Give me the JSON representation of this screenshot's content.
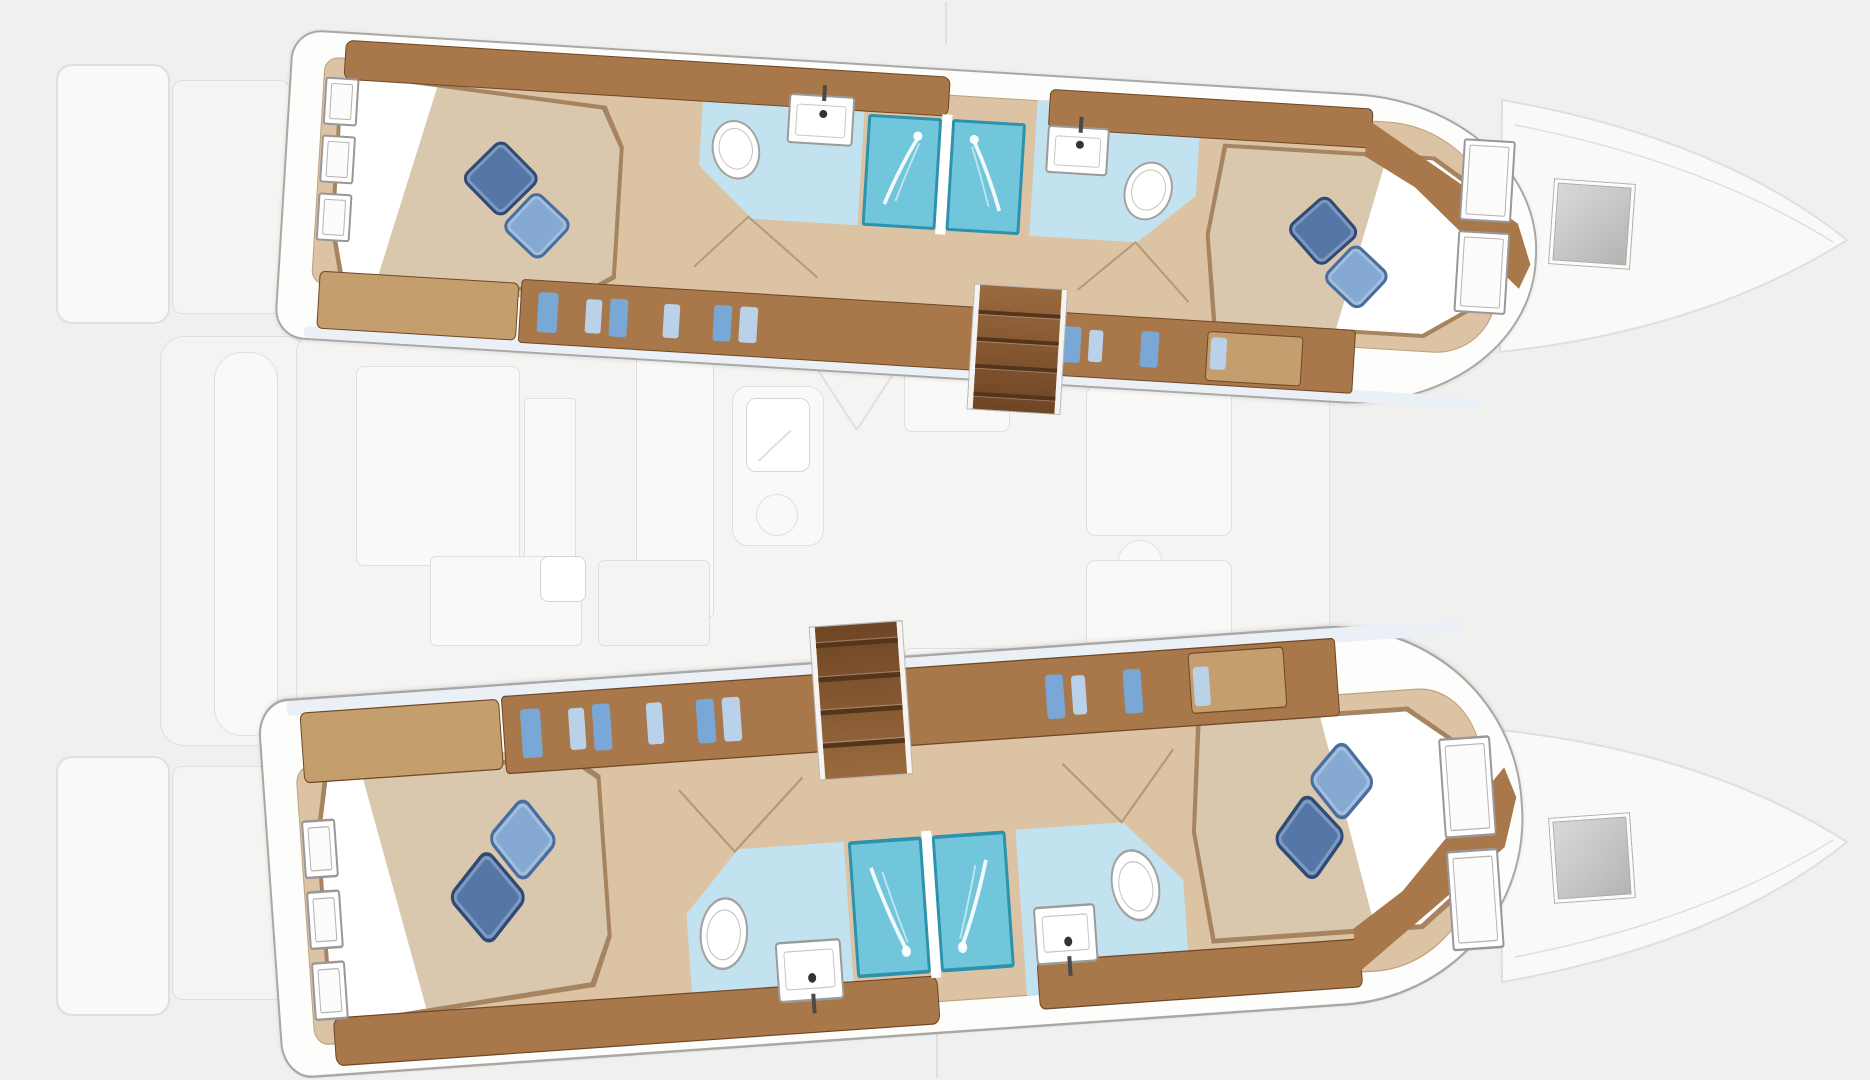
{
  "meta": {
    "description": "Catamaran sailing yacht deck/floor plan, top view. Lower-deck hull accommodations drawn in colour; main deck (saloon, cockpit, foredeck, trampoline, bows) shown as a faint grey ghost outline. No text labels are rendered in the image.",
    "inventory": {
      "double_cabins": 4,
      "bathrooms": 4,
      "shower_stalls": 4,
      "toilets": 4,
      "sinks": 4,
      "companionway_staircases": 2,
      "deck_hatches": 2,
      "pillows_per_bed": 2
    }
  },
  "palette": {
    "bg": "#f0f0ef",
    "ghost_fill": "#f9f9f8",
    "ghost_fill2": "#f4f4f2",
    "ghost_line": "#e0dfdd",
    "hull_fill": "#fdfdfc",
    "hull_line": "#a9a8a5",
    "wood": "#a8784a",
    "wood_dark": "#8a5a33",
    "wood_light": "#c59e6e",
    "wood_edge": "#6f4726",
    "floor": "#dcc3a3",
    "mattress": "#d9c8ad",
    "mattress_edge": "#a5845f",
    "sheet": "#ffffff",
    "pillow_dark": "#5577a8",
    "pillow_dark_edge": "#2e4a75",
    "pillow_light": "#85a9d2",
    "pillow_light_edge": "#4a6da0",
    "aqua": "#c2e2ef",
    "aqua_edge": "#8cc3da",
    "shower": "#72c6dc",
    "shower_edge": "#2d92ad",
    "fixture_edge": "#9b9b98",
    "stair_hi": "#9a6a3e",
    "stair_lo": "#6f4524",
    "stair_tread": "#54351b",
    "stair_rail": "#f5f4f2",
    "hatch_a": "#d9d9d8",
    "hatch_b": "#b3b3b1",
    "window_edge": "#98979a",
    "icon_blue": "#79a7d6",
    "icon_blue2": "#b9d2ea",
    "door_line": "#a98b66"
  },
  "ghost_paths": [
    {
      "n": "bow-deck-port",
      "d": "M1502,100 Q1720,138 1847,240 Q1705,330 1500,352 Z",
      "fill": "ghost_fill",
      "stroke": "ghost_line",
      "sw": 2
    },
    {
      "n": "bow-line-port",
      "d": "M1515,125 Q1705,162 1833,242",
      "fill": "none",
      "stroke": "ghost_line",
      "sw": 1.5
    },
    {
      "n": "bow-deck-starboard",
      "d": "M1500,730 Q1705,752 1847,842 Q1720,944 1502,982 Z",
      "fill": "ghost_fill",
      "stroke": "ghost_line",
      "sw": 2
    },
    {
      "n": "bow-line-starboard",
      "d": "M1515,957 Q1705,920 1833,840",
      "fill": "none",
      "stroke": "ghost_line",
      "sw": 1.5
    }
  ],
  "ghost_shapes": [
    {
      "n": "stern-swim-platform-port",
      "k": "rect",
      "x": 56,
      "y": 64,
      "w": 114,
      "h": 260,
      "rad": "16px",
      "f": "ghost_fill",
      "s": "ghost_line",
      "sw": 2,
      "tex": "tex-slats"
    },
    {
      "n": "stern-step-port",
      "k": "rect",
      "x": 172,
      "y": 80,
      "w": 118,
      "h": 234,
      "rad": "10px",
      "f": "ghost_fill2",
      "s": "ghost_line",
      "sw": 1,
      "tex": "tex-slats"
    },
    {
      "n": "stern-swim-platform-starboard",
      "k": "rect",
      "x": 56,
      "y": 756,
      "w": 114,
      "h": 260,
      "rad": "16px",
      "f": "ghost_fill",
      "s": "ghost_line",
      "sw": 2,
      "tex": "tex-slats"
    },
    {
      "n": "stern-step-starboard",
      "k": "rect",
      "x": 172,
      "y": 766,
      "w": 118,
      "h": 234,
      "rad": "10px",
      "f": "ghost_fill2",
      "s": "ghost_line",
      "sw": 1,
      "tex": "tex-slats"
    },
    {
      "n": "aft-cockpit-floor",
      "k": "rect",
      "x": 160,
      "y": 336,
      "w": 150,
      "h": 410,
      "rad": "24px",
      "f": "ghost_fill2",
      "s": "ghost_line",
      "sw": 1
    },
    {
      "n": "saloon-floor",
      "k": "rect",
      "x": 296,
      "y": 334,
      "w": 1034,
      "h": 414,
      "rad": "18px",
      "f": "ghost_fill2",
      "s": "ghost_line",
      "sw": 1,
      "tex": "tex-streaks"
    },
    {
      "n": "aft-cockpit-bench",
      "k": "rect",
      "x": 214,
      "y": 352,
      "w": 64,
      "h": 384,
      "rad": "28px",
      "f": "ghost_fill",
      "s": "ghost_line",
      "sw": 1
    },
    {
      "n": "cockpit-table",
      "k": "rect",
      "x": 356,
      "y": 366,
      "w": 164,
      "h": 200,
      "rad": "8px",
      "f": "ghost_fill",
      "s": "ghost_line",
      "sw": 1
    },
    {
      "n": "galley-strip",
      "k": "rect",
      "x": 524,
      "y": 398,
      "w": 52,
      "h": 176,
      "rad": "4px",
      "f": "ghost_fill",
      "s": "ghost_line",
      "sw": 1
    },
    {
      "n": "galley-counter",
      "k": "rect",
      "x": 636,
      "y": 346,
      "w": 78,
      "h": 272,
      "rad": "6px",
      "f": "ghost_fill",
      "s": "ghost_line",
      "sw": 1
    },
    {
      "n": "galley-sink-unit",
      "k": "rect",
      "x": 732,
      "y": 386,
      "w": 92,
      "h": 160,
      "rad": "16px",
      "f": "ghost_fill",
      "s": "ghost_line",
      "sw": 1.5
    },
    {
      "n": "galley-sink",
      "k": "rect",
      "x": 746,
      "y": 398,
      "w": 64,
      "h": 74,
      "rad": "10px",
      "f": "#ffffff",
      "s": "#d8d7d5",
      "sw": 1.5
    },
    {
      "n": "galley-faucet",
      "k": "line",
      "x1": 758,
      "y1": 460,
      "x2": 790,
      "y2": 430,
      "ghost": true
    },
    {
      "n": "galley-burner",
      "k": "circle",
      "cx": 777,
      "cy": 515,
      "r": 21,
      "f": "none",
      "s": "ghost_line",
      "sw": 1.5
    },
    {
      "n": "saloon-seat",
      "k": "rect",
      "x": 904,
      "y": 336,
      "w": 106,
      "h": 96,
      "rad": "8px",
      "f": "ghost_fill",
      "s": "ghost_line",
      "sw": 1
    },
    {
      "n": "door-swing-ghost-a",
      "k": "line",
      "x1": 806,
      "y1": 350,
      "x2": 858,
      "y2": 430,
      "ghost": true
    },
    {
      "n": "door-swing-ghost-b",
      "k": "line",
      "x1": 910,
      "y1": 350,
      "x2": 858,
      "y2": 430,
      "ghost": true
    },
    {
      "n": "nav-seat",
      "k": "rect",
      "x": 1100,
      "y": 330,
      "w": 100,
      "h": 52,
      "rad": "6px",
      "f": "ghost_fill2",
      "s": "ghost_line",
      "sw": 1
    },
    {
      "n": "nav-table",
      "k": "rect",
      "x": 1086,
      "y": 386,
      "w": 146,
      "h": 150,
      "rad": "10px",
      "f": "ghost_fill",
      "s": "ghost_line",
      "sw": 1
    },
    {
      "n": "stool",
      "k": "circle",
      "cx": 1140,
      "cy": 562,
      "r": 22,
      "f": "ghost_fill",
      "s": "ghost_line",
      "sw": 1.5
    },
    {
      "n": "galley-counter-low",
      "k": "rect",
      "x": 430,
      "y": 556,
      "w": 152,
      "h": 90,
      "rad": "6px",
      "f": "ghost_fill",
      "s": "ghost_line",
      "sw": 1
    },
    {
      "n": "galley-sink-low",
      "k": "rect",
      "x": 540,
      "y": 556,
      "w": 46,
      "h": 46,
      "rad": "8px",
      "f": "#ffffff",
      "s": "#d5d4d2",
      "sw": 1.5
    },
    {
      "n": "counter-low-2",
      "k": "rect",
      "x": 598,
      "y": 560,
      "w": 112,
      "h": 86,
      "rad": "6px",
      "f": "ghost_fill2",
      "s": "ghost_line",
      "sw": 1
    },
    {
      "n": "saloon-seat-low",
      "k": "rect",
      "x": 904,
      "y": 648,
      "w": 106,
      "h": 94,
      "rad": "8px",
      "f": "ghost_fill",
      "s": "ghost_line",
      "sw": 1
    },
    {
      "n": "dinette-low",
      "k": "rect",
      "x": 1086,
      "y": 560,
      "w": 146,
      "h": 128,
      "rad": "10px",
      "f": "ghost_fill",
      "s": "ghost_line",
      "sw": 1
    },
    {
      "n": "mast-line",
      "k": "line",
      "x1": 947,
      "y1": 2,
      "x2": 947,
      "y2": 44,
      "ghost": true
    },
    {
      "n": "forestay-line",
      "k": "line",
      "x1": 938,
      "y1": 1016,
      "x2": 938,
      "y2": 1078,
      "ghost": true
    }
  ],
  "hatches": [
    {
      "n": "deck-hatch-port",
      "x": 1552,
      "y": 182,
      "w": 80,
      "h": 84,
      "rot": 4
    },
    {
      "n": "deck-hatch-starboard",
      "x": 1552,
      "y": 816,
      "w": 80,
      "h": 84,
      "rot": -4
    }
  ],
  "hulls": [
    {
      "id": "hull-port",
      "n": "port-hull-accommodation",
      "left": 283,
      "top": 30,
      "w": 1270,
      "h": 310,
      "origin": "30px 155px",
      "transform": "rotate(3.5deg)",
      "stair_x": 697
    },
    {
      "id": "hull-starboard",
      "n": "starboard-hull-accommodation",
      "left": 283,
      "top": 700,
      "w": 1270,
      "h": 310,
      "origin": "0 0",
      "transform": "translateY(380px) rotate(-4deg) scaleY(-1.226)",
      "stair_x": 557
    }
  ],
  "hull_template": [
    {
      "n": "hull-outline",
      "k": "rect",
      "x": 0,
      "y": 0,
      "w": 1256,
      "h": 310,
      "rad": "30px 190px 190px 30px / 30px 152px 152px 30px",
      "f": "hull_fill",
      "s": "hull_line",
      "sw": 2,
      "shadow": true
    },
    {
      "n": "inboard-edge-band",
      "k": "rect",
      "x": 30,
      "y": 296,
      "w": 1180,
      "h": 12,
      "rad": "4px",
      "f": "#eaf0f5"
    },
    {
      "n": "cabin-sole-floor",
      "k": "rect",
      "x": 34,
      "y": 26,
      "w": 1184,
      "h": 228,
      "rad": "14px 120px 60px 14px",
      "f": "floor",
      "tex": "tex-plank",
      "inset": "0 0 0 1px rgba(150,120,85,.45)"
    },
    {
      "n": "aft-bathroom-floor",
      "k": "poly",
      "pts": [
        [
          414,
          26
        ],
        [
          576,
          26
        ],
        [
          576,
          162
        ],
        [
          470,
          162
        ],
        [
          414,
          112
        ]
      ],
      "f": "aqua",
      "tex": "tex-tile"
    },
    {
      "n": "fwd-bathroom-floor",
      "k": "poly",
      "pts": [
        [
          748,
          26
        ],
        [
          912,
          26
        ],
        [
          912,
          112
        ],
        [
          856,
          162
        ],
        [
          748,
          162
        ]
      ],
      "f": "aqua",
      "tex": "tex-tile"
    },
    {
      "n": "aft-bed-base",
      "k": "poly",
      "pts": [
        [
          62,
          40
        ],
        [
          318,
          58
        ],
        [
          338,
          98
        ],
        [
          338,
          230
        ],
        [
          310,
          248
        ],
        [
          62,
          248
        ],
        [
          50,
          196
        ],
        [
          50,
          92
        ]
      ],
      "f": "mattress_edge"
    },
    {
      "n": "aft-bed",
      "k": "poly",
      "pts": [
        [
          66,
          44
        ],
        [
          314,
          62
        ],
        [
          334,
          100
        ],
        [
          334,
          227
        ],
        [
          307,
          244
        ],
        [
          66,
          244
        ],
        [
          54,
          194
        ],
        [
          54,
          94
        ]
      ],
      "f": "mattress",
      "tex": "tex-mattress"
    },
    {
      "n": "aft-bed-sheet",
      "k": "poly",
      "pts": [
        [
          66,
          44
        ],
        [
          148,
          50
        ],
        [
          100,
          244
        ],
        [
          66,
          244
        ],
        [
          54,
          194
        ],
        [
          54,
          94
        ]
      ],
      "f": "sheet"
    },
    {
      "n": "fwd-bed-base",
      "k": "poly",
      "pts": [
        [
          936,
          58
        ],
        [
          1148,
          58
        ],
        [
          1208,
          96
        ],
        [
          1224,
          148
        ],
        [
          1206,
          202
        ],
        [
          1148,
          240
        ],
        [
          936,
          240
        ],
        [
          924,
          150
        ]
      ],
      "f": "mattress_edge"
    },
    {
      "n": "fwd-bed",
      "k": "poly",
      "pts": [
        [
          940,
          62
        ],
        [
          1146,
          62
        ],
        [
          1204,
          100
        ],
        [
          1220,
          148
        ],
        [
          1202,
          200
        ],
        [
          1146,
          236
        ],
        [
          940,
          236
        ],
        [
          928,
          150
        ]
      ],
      "f": "mattress",
      "tex": "tex-mattress"
    },
    {
      "n": "fwd-bed-sheet",
      "k": "poly",
      "pts": [
        [
          1100,
          62
        ],
        [
          1146,
          62
        ],
        [
          1204,
          100
        ],
        [
          1220,
          148
        ],
        [
          1202,
          200
        ],
        [
          1146,
          236
        ],
        [
          1060,
          236
        ]
      ],
      "f": "sheet"
    },
    {
      "n": "aft-wood-shelf",
      "k": "rect",
      "x": 54,
      "y": 8,
      "w": 606,
      "h": 40,
      "rad": "8px",
      "f": "wood",
      "s": "wood_edge",
      "sw": 1,
      "tex": "tex-woodgrain"
    },
    {
      "n": "fwd-wood-shelf",
      "k": "rect",
      "x": 760,
      "y": 14,
      "w": 324,
      "h": 40,
      "rad": "6px",
      "f": "wood",
      "s": "wood_edge",
      "sw": 1,
      "tex": "tex-woodgrain"
    },
    {
      "n": "bow-trim",
      "k": "poly",
      "pts": [
        [
          1080,
          26
        ],
        [
          1235,
          120
        ],
        [
          1250,
          160
        ],
        [
          1240,
          185
        ],
        [
          1130,
          90
        ],
        [
          1078,
          62
        ]
      ],
      "f": "wood",
      "shadow": true
    },
    {
      "n": "aft-dresser",
      "k": "rect",
      "x": 42,
      "y": 240,
      "w": 200,
      "h": 58,
      "rad": "6px",
      "f": "wood_light",
      "s": "wood_edge",
      "sw": 1,
      "tex": "tex-woodgrain"
    },
    {
      "n": "wardrobe-row",
      "k": "rect",
      "x": 244,
      "y": 236,
      "w": 836,
      "h": 64,
      "rad": "4px",
      "f": "wood",
      "s": "wood_edge",
      "sw": 1,
      "tex": "tex-doors"
    },
    {
      "n": "fwd-dresser",
      "k": "rect",
      "x": 932,
      "y": 246,
      "w": 96,
      "h": 50,
      "rad": "4px",
      "f": "wood_light",
      "s": "wood_edge",
      "sw": 1,
      "tex": "tex-woodgrain"
    },
    {
      "n": "wardrobe-item",
      "k": "rect",
      "x": 262,
      "y": 248,
      "w": 20,
      "h": 40,
      "rad": "3px",
      "f": "icon_blue"
    },
    {
      "n": "wardrobe-item",
      "k": "rect",
      "x": 310,
      "y": 252,
      "w": 16,
      "h": 34,
      "rad": "3px",
      "f": "icon_blue2"
    },
    {
      "n": "wardrobe-item",
      "k": "rect",
      "x": 334,
      "y": 250,
      "w": 18,
      "h": 38,
      "rad": "3px",
      "f": "icon_blue"
    },
    {
      "n": "wardrobe-item",
      "k": "rect",
      "x": 388,
      "y": 252,
      "w": 16,
      "h": 34,
      "rad": "3px",
      "f": "icon_blue2"
    },
    {
      "n": "wardrobe-item",
      "k": "rect",
      "x": 438,
      "y": 250,
      "w": 18,
      "h": 36,
      "rad": "3px",
      "f": "icon_blue"
    },
    {
      "n": "wardrobe-item",
      "k": "rect",
      "x": 464,
      "y": 250,
      "w": 18,
      "h": 36,
      "rad": "3px",
      "f": "icon_blue2"
    },
    {
      "n": "wardrobe-item",
      "k": "rect",
      "x": 788,
      "y": 250,
      "w": 18,
      "h": 36,
      "rad": "3px",
      "f": "icon_blue"
    },
    {
      "n": "wardrobe-item",
      "k": "rect",
      "x": 814,
      "y": 252,
      "w": 14,
      "h": 32,
      "rad": "3px",
      "f": "icon_blue2"
    },
    {
      "n": "wardrobe-item",
      "k": "rect",
      "x": 866,
      "y": 250,
      "w": 18,
      "h": 36,
      "rad": "3px",
      "f": "icon_blue"
    },
    {
      "n": "wardrobe-item",
      "k": "rect",
      "x": 936,
      "y": 252,
      "w": 16,
      "h": 32,
      "rad": "3px",
      "f": "icon_blue2"
    },
    {
      "n": "hull-window",
      "k": "window",
      "x": 36,
      "y": 46,
      "w": 34,
      "h": 48
    },
    {
      "n": "hull-window",
      "k": "window",
      "x": 36,
      "y": 104,
      "w": 34,
      "h": 48
    },
    {
      "n": "hull-window",
      "k": "window",
      "x": 36,
      "y": 162,
      "w": 34,
      "h": 48
    },
    {
      "n": "hull-window",
      "k": "window",
      "x": 1176,
      "y": 38,
      "w": 52,
      "h": 82
    },
    {
      "n": "hull-window",
      "k": "window",
      "x": 1176,
      "y": 130,
      "w": 52,
      "h": 82
    },
    {
      "n": "shower-stall",
      "k": "shower",
      "x": 580,
      "y": 50,
      "w": 74,
      "h": 112
    },
    {
      "n": "shower-stall",
      "k": "shower",
      "x": 664,
      "y": 50,
      "w": 74,
      "h": 112,
      "flip": true
    },
    {
      "n": "shower-divider",
      "k": "rect",
      "x": 654,
      "y": 46,
      "w": 10,
      "h": 120,
      "f": "#ffffff"
    },
    {
      "n": "bathroom-sink",
      "k": "sink",
      "x": 500,
      "y": 34,
      "w": 66,
      "h": 50
    },
    {
      "n": "bathroom-sink",
      "k": "sink",
      "x": 760,
      "y": 50,
      "w": 62,
      "h": 48
    },
    {
      "n": "toilet",
      "k": "toilet",
      "x": 426,
      "y": 64,
      "w": 48,
      "h": 60,
      "rot": -16
    },
    {
      "n": "toilet",
      "k": "toilet",
      "x": 840,
      "y": 80,
      "w": 48,
      "h": 60,
      "rot": 16
    },
    {
      "n": "door-swing-line",
      "k": "line",
      "x1": 468,
      "y1": 160,
      "x2": 540,
      "y2": 216
    },
    {
      "n": "door-swing-line",
      "k": "line",
      "x1": 468,
      "y1": 160,
      "x2": 416,
      "y2": 214
    },
    {
      "n": "door-swing-line",
      "k": "line",
      "x1": 856,
      "y1": 162,
      "x2": 912,
      "y2": 218
    },
    {
      "n": "door-swing-line",
      "k": "line",
      "x1": 856,
      "y1": 162,
      "x2": 800,
      "y2": 214
    },
    {
      "n": "bed-pillow",
      "k": "pillow",
      "x": 188,
      "y": 108,
      "sz": 58,
      "f": "pillow_dark",
      "s": "pillow_dark_edge",
      "rot": 42
    },
    {
      "n": "bed-pillow",
      "k": "pillow",
      "x": 230,
      "y": 156,
      "sz": 52,
      "f": "pillow_light",
      "s": "pillow_light_edge",
      "rot": 40
    },
    {
      "n": "bed-pillow",
      "k": "pillow",
      "x": 1014,
      "y": 112,
      "sz": 54,
      "f": "pillow_dark",
      "s": "pillow_dark_edge",
      "rot": 45
    },
    {
      "n": "bed-pillow",
      "k": "pillow",
      "x": 1052,
      "y": 158,
      "sz": 50,
      "f": "pillow_light",
      "s": "pillow_light_edge",
      "rot": 40
    },
    {
      "n": "companionway-stairs",
      "k": "stairs",
      "x": -1,
      "y": 214,
      "w": 92,
      "h": 124
    }
  ]
}
